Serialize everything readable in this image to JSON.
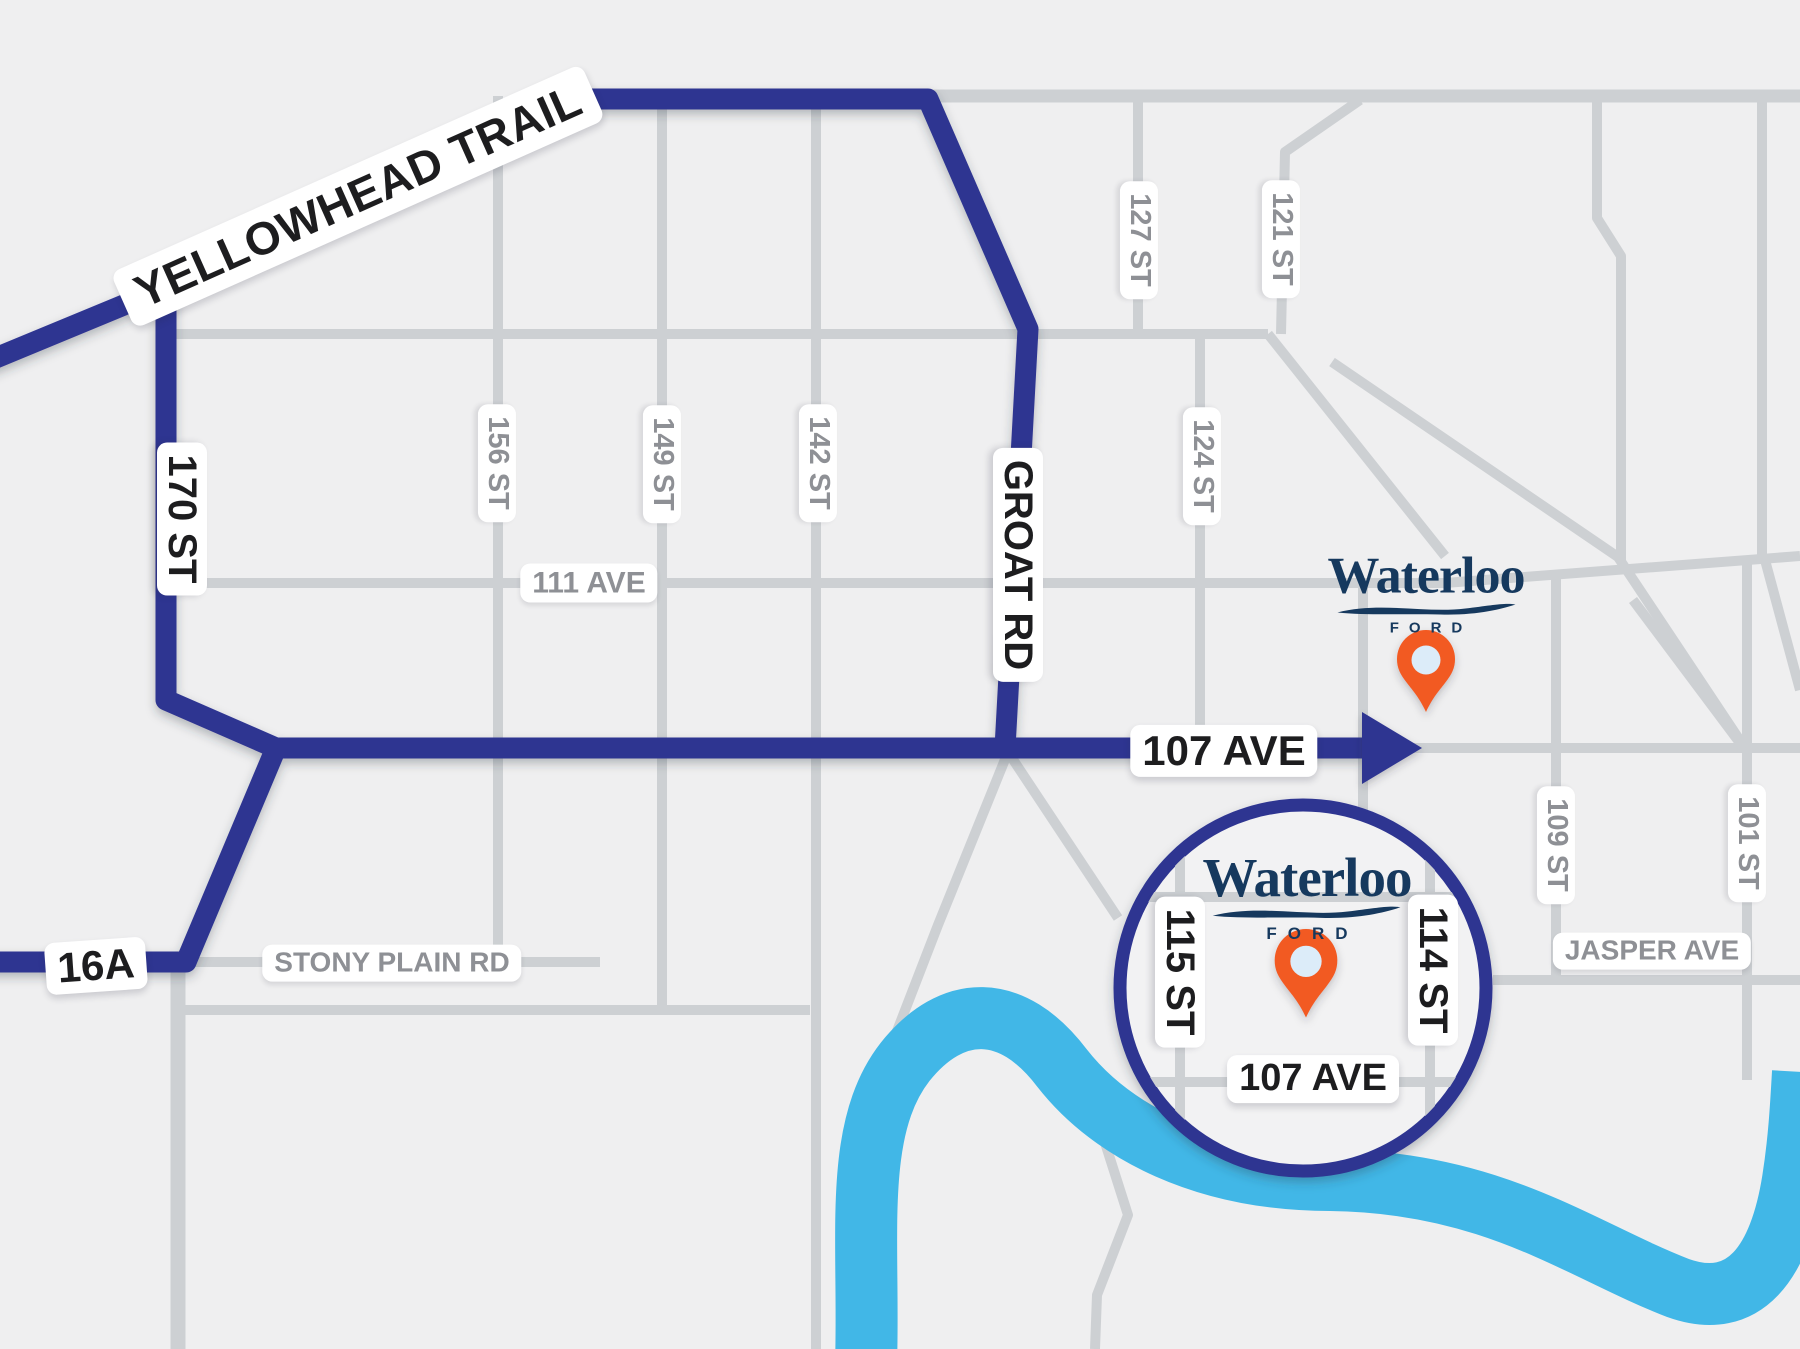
{
  "map": {
    "description": "Stylized directions map to Waterloo Ford dealership",
    "colors": {
      "background": "#efeff0",
      "road_gray": "#cdd0d3",
      "route_navy": "#2e3591",
      "river_blue": "#41b7e7",
      "pin_orange": "#f25a22",
      "pin_center": "#dcecf9",
      "logo_navy": "#16395e",
      "label_dark": "#1d1d1f",
      "label_gray": "#8e9095"
    },
    "labels": {
      "yellowhead_trail": "YELLOWHEAD TRAIL",
      "st_170": "170 ST",
      "groat_rd": "GROAT RD",
      "ave_107": "107 AVE",
      "hwy_16a": "16A",
      "stony_plain_rd": "STONY PLAIN RD",
      "ave_111": "111 AVE",
      "st_156": "156 ST",
      "st_149": "149 ST",
      "st_142": "142 ST",
      "st_127": "127 ST",
      "st_121": "121 ST",
      "st_124": "124 ST",
      "st_109": "109 ST",
      "st_101": "101 ST",
      "jasper_ave": "JASPER AVE"
    },
    "dealership": {
      "name": "Waterloo",
      "brand": "FORD"
    },
    "inset": {
      "st_115": "115 ST",
      "st_114": "114 ST",
      "ave_107": "107 AVE"
    }
  }
}
